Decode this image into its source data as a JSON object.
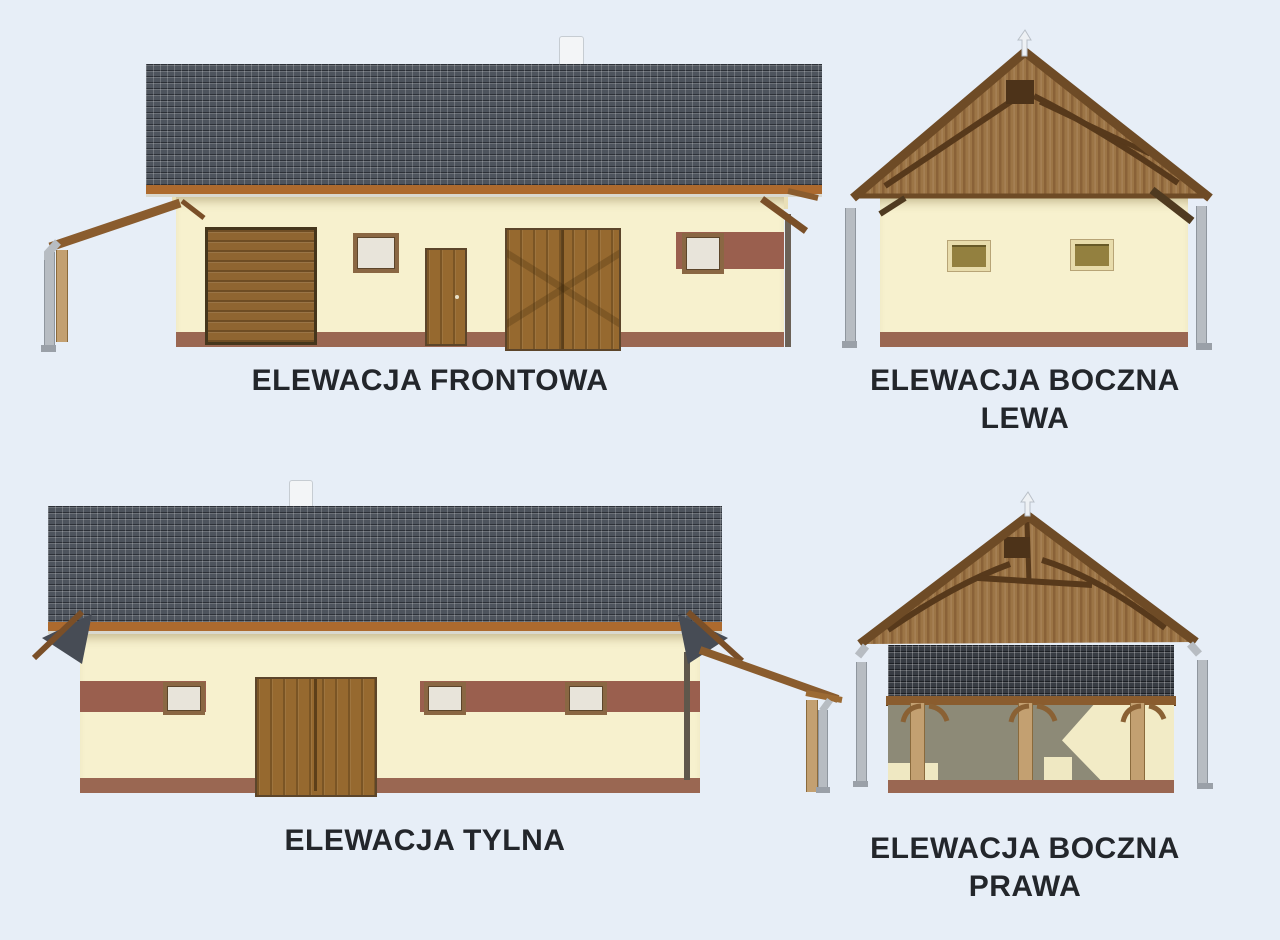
{
  "sheet": {
    "type": "architectural-elevations",
    "background_color": "#e7eef7",
    "label_text_color": "#23262b"
  },
  "figures": {
    "front": {
      "caption": "ELEWACJA FRONTOWA"
    },
    "side_left": {
      "caption_line1": "ELEWACJA BOCZNA",
      "caption_line2": "LEWA"
    },
    "rear": {
      "caption": "ELEWACJA TYLNA"
    },
    "side_right": {
      "caption_line1": "ELEWACJA BOCZNA",
      "caption_line2": "PRAWA"
    }
  },
  "colors": {
    "roof_tile": "#4e545d",
    "carport_roof_tile": "#383c43",
    "roof_fascia": "#ad6a2e",
    "wall": "#f7f1ce",
    "plinth": "#9a6752",
    "accent_band": "#9a5f4e",
    "door_wood": "#8f6531",
    "gable_wood": "#9c7546",
    "truss_dark": "#57391b",
    "post_tan": "#c3a071",
    "downspout_gray": "#b7bcc2",
    "carport_shadow": "#8d8a77"
  }
}
